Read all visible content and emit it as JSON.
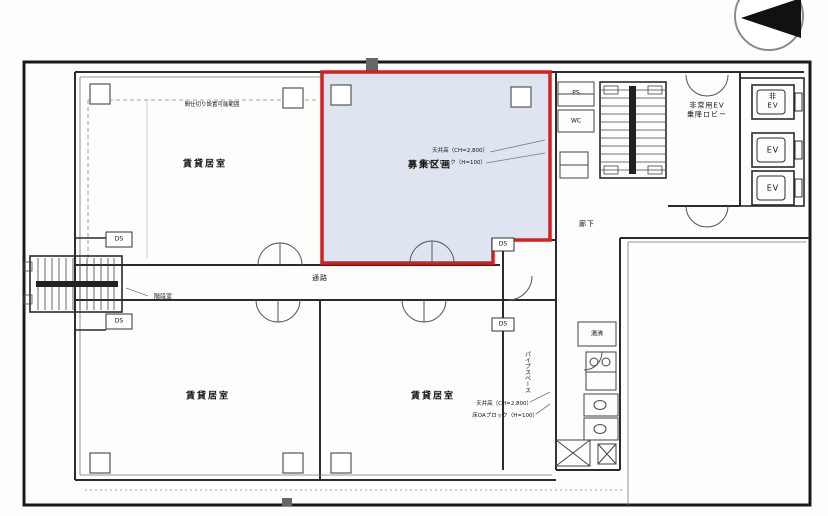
{
  "drawing": {
    "rooms": {
      "upper_left": "賃貸居室",
      "highlight": "募集区画",
      "lower_left": "賃貸居室",
      "lower_center": "賃貸居室",
      "corridor": "通路",
      "hallway": "廊下",
      "ev_lobby": "非常用EV\n乗降ロビー",
      "stair_room": "階段室",
      "kitchenette": "湯沸"
    },
    "elevators": {
      "emergency": "非\nEV",
      "ev2": "EV",
      "ev3": "EV"
    },
    "shafts": {
      "ds": "DS",
      "ps": "PS",
      "wc": "WC",
      "pipe_shaft_vertical": "パイプスペース"
    },
    "annotations": {
      "ceiling_note": "間仕切り設置可能範囲",
      "highlight_ceiling": "天井高（CH=2,800）",
      "highlight_floor": "床OAブロック（H=100）",
      "lower_ceiling": "天井高（CH=2,800）",
      "lower_floor": "床OAブロック（H=100）"
    },
    "colors": {
      "highlight_fill": "#dbe2ee",
      "highlight_border": "#d6201f",
      "line": "#2b2b2b",
      "background": "#ffffff"
    }
  }
}
